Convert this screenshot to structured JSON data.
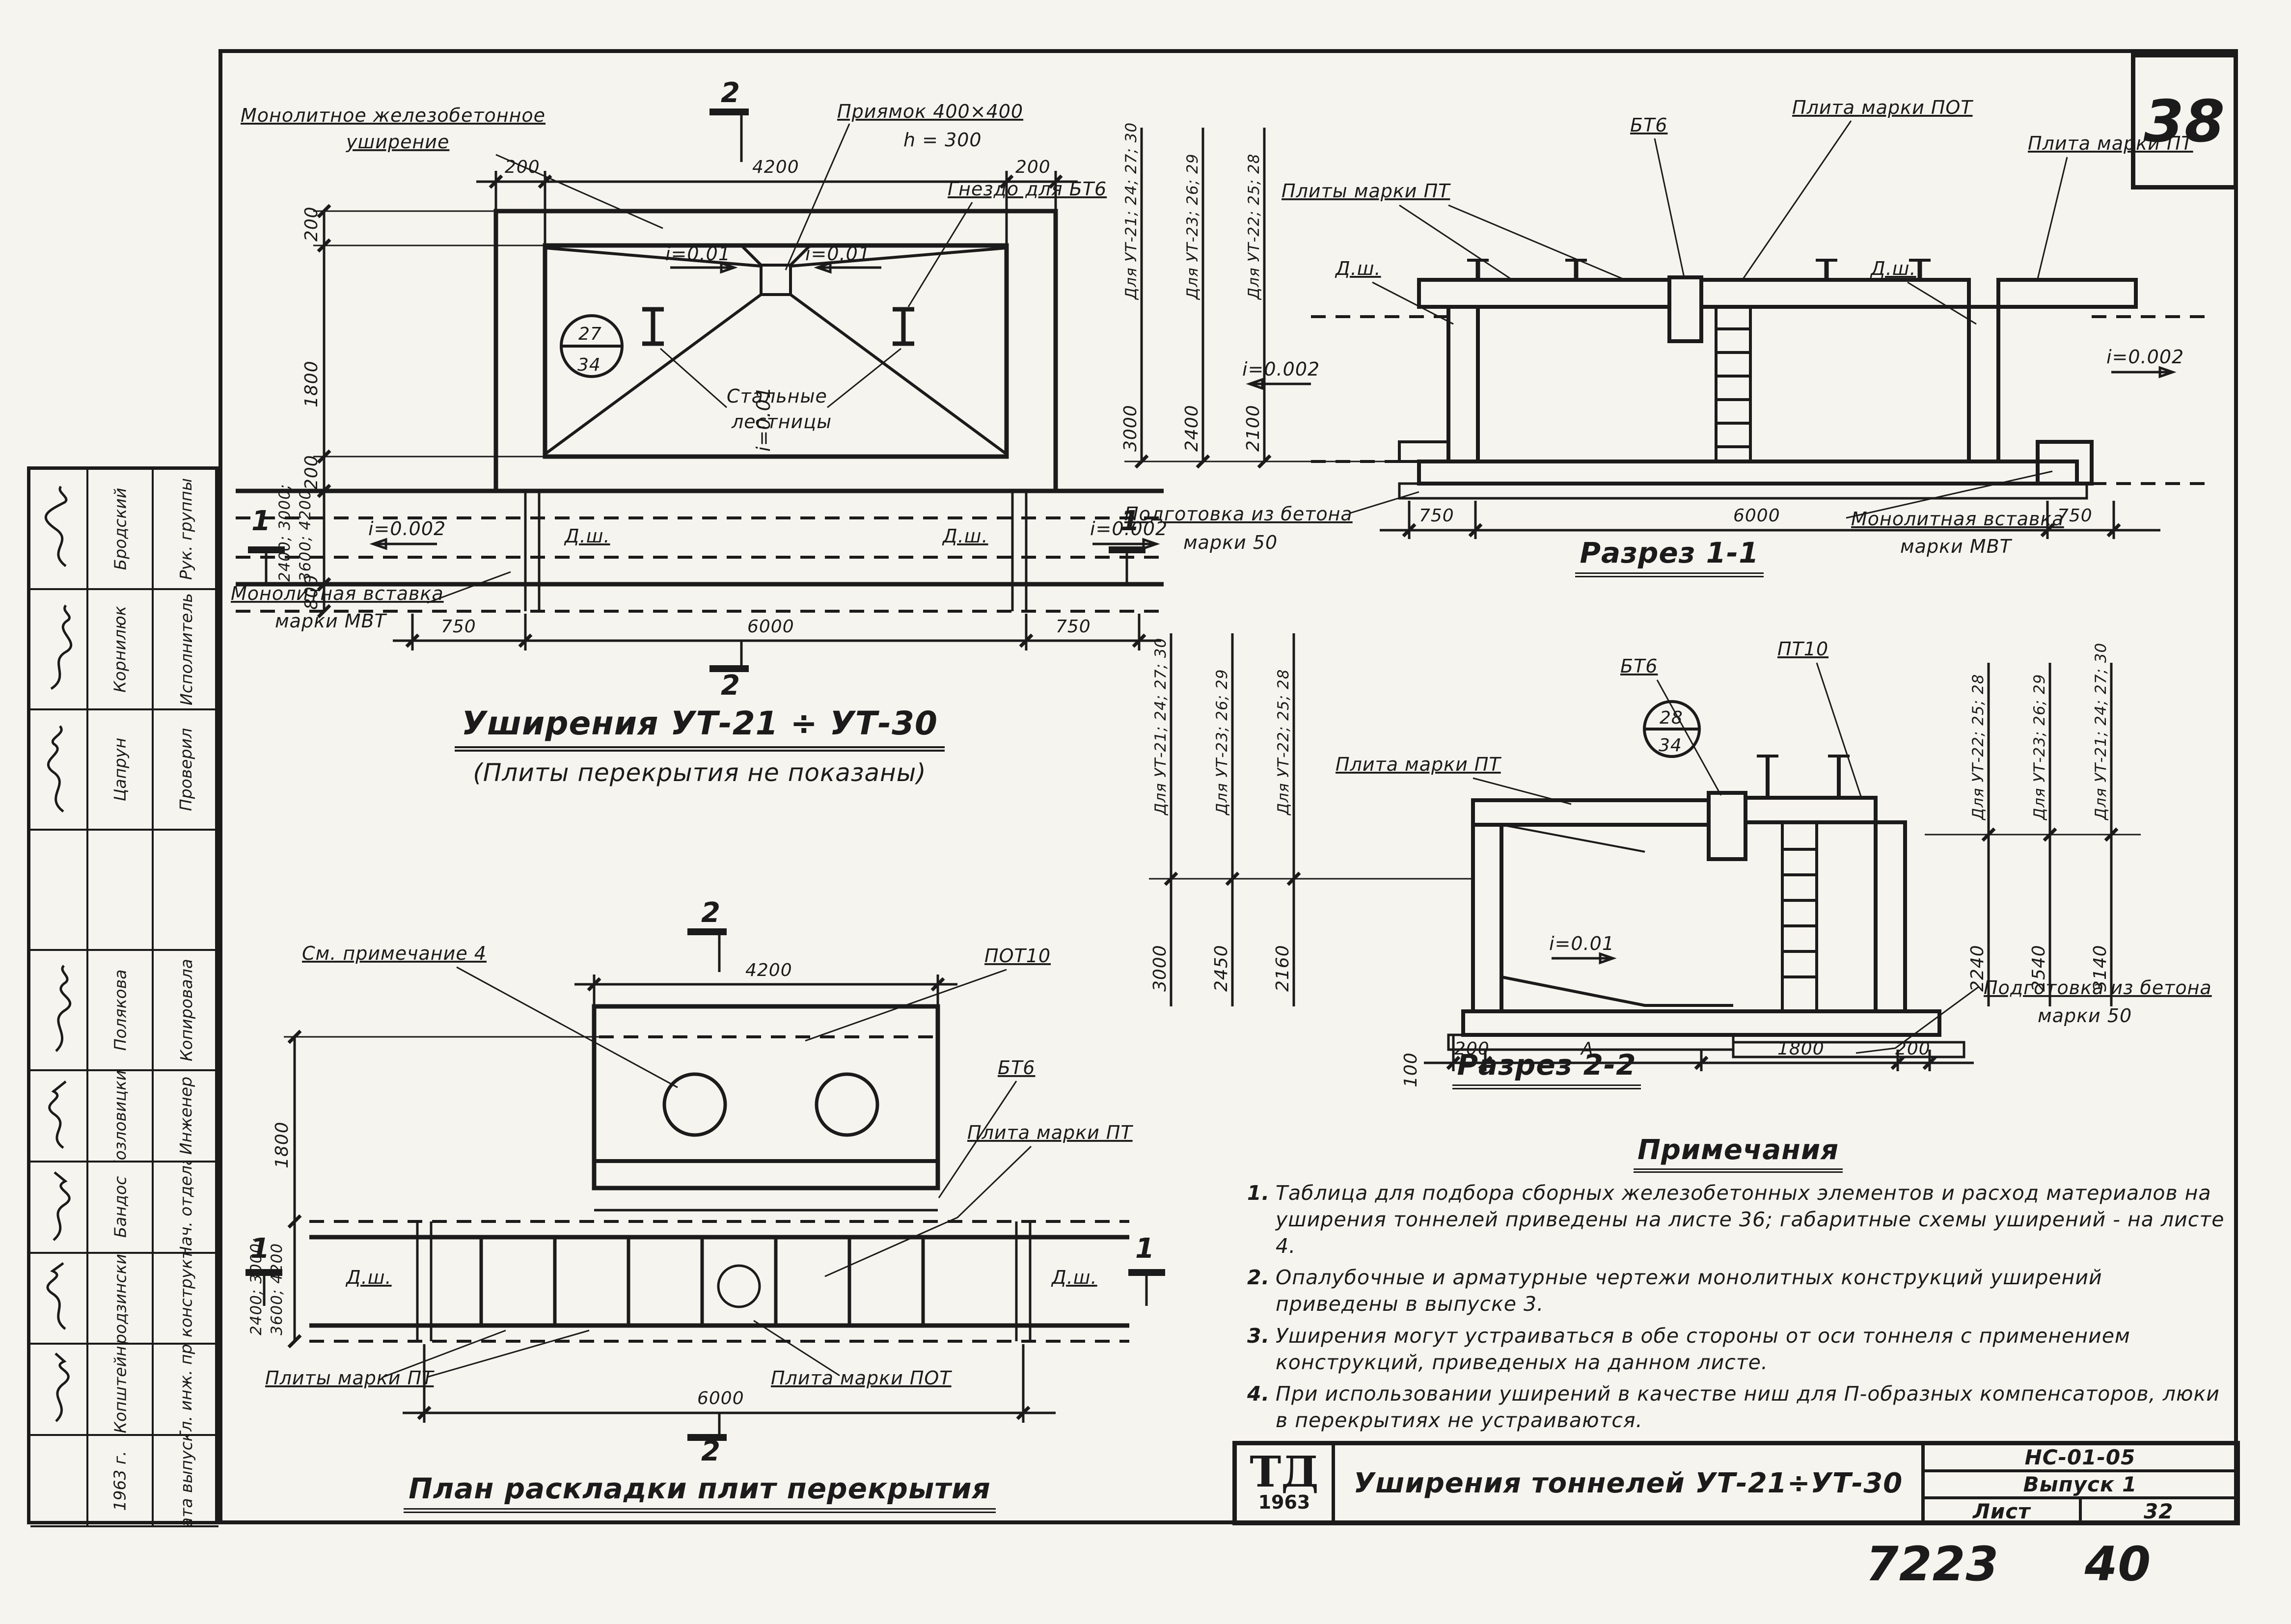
{
  "sheet": {
    "page_number": "38",
    "doc_number": "7223",
    "doc_number2": "40"
  },
  "plan": {
    "title": "Уширения  УТ-21 ÷ УТ-30",
    "subtitle": "(Плиты  перекрытия  не  показаны)",
    "label_monolithic_1": "Монолитное  железобетонное",
    "label_monolithic_2": "уширение",
    "label_pit": "Приямок  400×400",
    "label_pit_h": "h = 300",
    "label_socket": "Гнездо  для  БТ6",
    "label_stairs_1": "Стальные",
    "label_stairs_2": "лестницы",
    "label_insert_1": "Монолитная  вставка",
    "label_insert_2": "марки  МВТ",
    "bubble_top": "27",
    "bubble_bottom": "34",
    "slope_pit_left": "i=0.01",
    "slope_pit_right": "i=0.01",
    "slope_center": "i=0.01",
    "slope_left": "i=0.002",
    "slope_right": "i=0.002",
    "dsh_left": "Д.ш.",
    "dsh_right": "Д.ш.",
    "dim_top": [
      "200",
      "4200",
      "200"
    ],
    "dim_left": [
      "200",
      "1800",
      "200",
      "2400; 3000;",
      "3600; 4200",
      "800"
    ],
    "dim_bottom": [
      "750",
      "6000",
      "750"
    ],
    "marker_top": "2",
    "marker_bottom": "2",
    "marker_left": "1",
    "marker_right": "1"
  },
  "slab_plan": {
    "title": "План  раскладки  плит  перекрытия",
    "label_note": "См. примечание 4",
    "label_pot10": "ПОТ10",
    "label_bt6": "БТ6",
    "label_pt": "Плита  марки  ПТ",
    "label_pt_plates": "Плиты  марки  ПТ",
    "label_pot": "Плита  марки  ПОТ",
    "dsh_left": "Д.ш.",
    "dsh_right": "Д.ш.",
    "dim_top": "4200",
    "dim_bottom": "6000",
    "dim_left_1": "1800",
    "dim_left_2": "2400; 3000;",
    "dim_left_3": "3600; 4200",
    "marker_top": "2",
    "marker_bottom": "2",
    "marker_left": "1",
    "marker_right": "1"
  },
  "section11": {
    "title": "Разрез  1-1",
    "group_labels": [
      "Для УТ-21; 24; 27; 30",
      "Для УТ-23; 26; 29",
      "Для УТ-22; 25; 28"
    ],
    "dims_height": [
      "3000",
      "2400",
      "2100"
    ],
    "label_pt_plates": "Плиты  марки  ПТ",
    "label_bt6": "БТ6",
    "label_pot": "Плита  марки  ПОТ",
    "label_pt": "Плита  марки  ПТ",
    "dsh_left": "Д.ш.",
    "dsh_right": "Д.ш.",
    "slope_left": "i=0.002",
    "slope_right": "i=0.002",
    "label_prep_1": "Подготовка  из  бетона",
    "label_prep_2": "марки  50",
    "label_insert_1": "Монолитная  вставка",
    "label_insert_2": "марки  МВТ",
    "dim_bottom": [
      "750",
      "6000",
      "750"
    ]
  },
  "section22": {
    "title": "Разрез  2-2",
    "group_labels_left": [
      "Для УТ-21; 24; 27; 30",
      "Для УТ-23; 26; 29",
      "Для УТ-22; 25; 28"
    ],
    "dims_left": [
      "3000",
      "2450",
      "2160"
    ],
    "group_labels_right": [
      "Для УТ-22; 25; 28",
      "Для УТ-23; 26; 29",
      "Для УТ-21; 24; 27; 30"
    ],
    "dims_right": [
      "2240",
      "2540",
      "3140"
    ],
    "label_pt": "Плита  марки  ПТ",
    "label_bt6": "БТ6",
    "label_pt10": "ПТ10",
    "bubble_top": "28",
    "bubble_bottom": "34",
    "slope": "i=0.01",
    "label_prep_1": "Подготовка  из  бетона",
    "label_prep_2": "марки  50",
    "dim_bottom": [
      "200",
      "А",
      "1800",
      "200"
    ],
    "dim_100": "100"
  },
  "notes": {
    "heading": "Примечания",
    "items": [
      {
        "num": "1.",
        "text": "Таблица для подбора сборных железобетонных элементов и расход материалов на уширения тоннелей приведены на листе 36; габаритные схемы уширений - на листе 4."
      },
      {
        "num": "2.",
        "text": "Опалубочные и арматурные чертежи монолитных конструкций уширений приведены в выпуске 3."
      },
      {
        "num": "3.",
        "text": "Уширения могут устраиваться в обе стороны от оси тоннеля с применением конструкций, приведеных на данном листе."
      },
      {
        "num": "4.",
        "text": "При использовании уширений в качестве ниш для П-образных компенсаторов, люки в перекрытиях не устраиваются."
      }
    ]
  },
  "titleblock": {
    "logo_top": "ТД",
    "logo_year": "1963",
    "title": "Уширения  тоннелей  УТ-21÷УТ-30",
    "code": "НС-01-05",
    "issue": "Выпуск 1",
    "sheet_label": "Лист",
    "sheet_number": "32"
  },
  "sidebar": {
    "rows": [
      {
        "role": "Рук. группы",
        "name": "Бродский"
      },
      {
        "role": "Исполнитель",
        "name": "Корнилюк"
      },
      {
        "role": "Проверил",
        "name": "Цапрун"
      },
      {
        "role": "",
        "name": ""
      },
      {
        "role": "Копировала",
        "name": "Полякова"
      },
      {
        "role": "Инженер",
        "name": "Козловицкий"
      },
      {
        "role": "Нач. отдела",
        "name": "Бандос"
      },
      {
        "role": "Гл. конструктор",
        "name": "Гродзинский"
      },
      {
        "role": "Гл. инж. пр.",
        "name": "Копштейн"
      },
      {
        "role": "Дата выпуска",
        "name": "1963 г."
      }
    ]
  }
}
